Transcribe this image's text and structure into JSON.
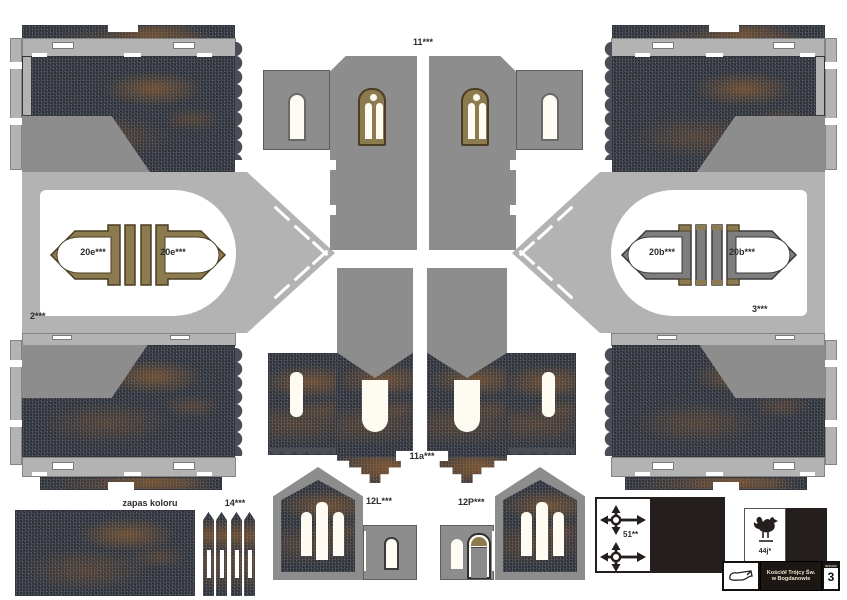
{
  "sheet": {
    "labels": {
      "piece2": "2***",
      "piece3": "3***",
      "piece11": "11***",
      "piece11a": "11a***",
      "piece12L": "12L***",
      "piece12P": "12P***",
      "piece14": "14***",
      "portal20e_left": "20e***",
      "portal20e_right": "20e***",
      "portal20b_left": "20b***",
      "portal20b_right": "20b***",
      "piece51": "51**",
      "piece44": "44j*",
      "color_spare": "zapas koloru"
    },
    "publisher": {
      "title_line1": "Kościół Trójcy Św.",
      "title_line2": "w Bogdanowie",
      "sheet_word": "arkusz",
      "sheet_number": "3"
    },
    "icons": {
      "cross": "weathervane-cross-icon",
      "rooster": "weathercock-rooster-icon",
      "logo": "publisher-logo-icon"
    },
    "colors": {
      "wall_gray": "#8d8d8d",
      "light_gray": "#b3b3b3",
      "stone_dark": "#4a4e57",
      "rust": "#a66a2f",
      "frame_tan": "#8d7b50",
      "frame_dark": "#4a3d22",
      "ink_black": "#241f1d",
      "window_white": "#fdfbf2"
    }
  }
}
